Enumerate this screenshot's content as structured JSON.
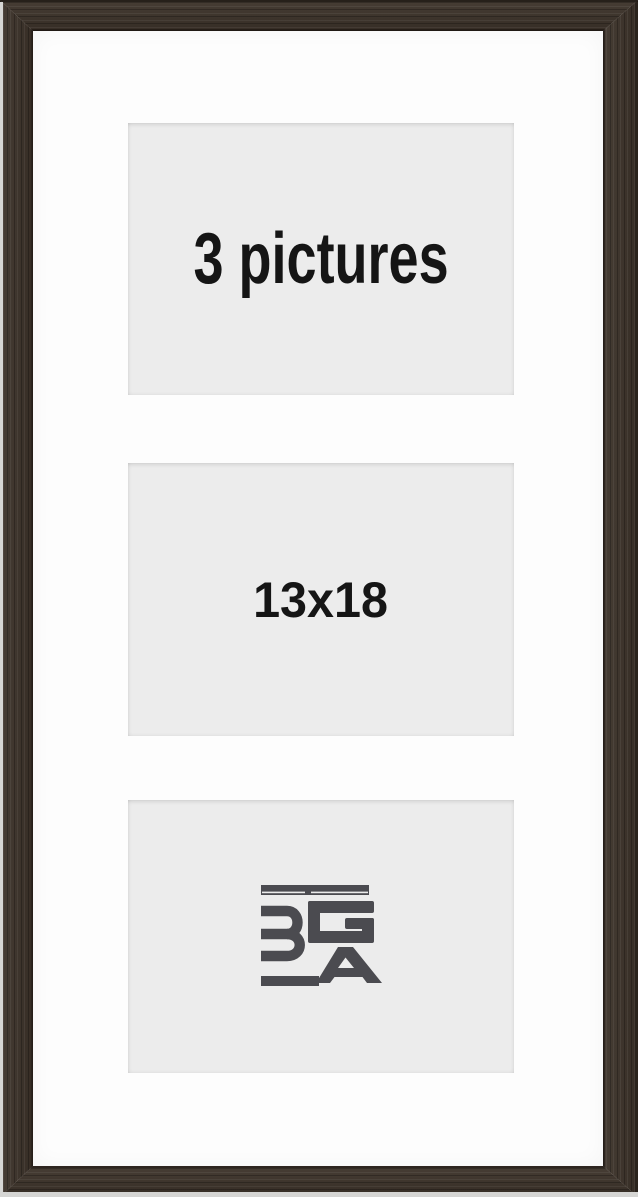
{
  "frame_photo": {
    "description": "triple-opening picture frame product photo",
    "openings": [
      {
        "type": "text",
        "label": "3 pictures"
      },
      {
        "type": "text",
        "label": "13x18"
      },
      {
        "type": "logo",
        "label": "BGA"
      }
    ],
    "colors": {
      "frame_wood": "#3d332a",
      "frame_edge_light": "#d6d6d4",
      "mat": "#fdfdfd",
      "opening_background": "#ececec",
      "label_text": "#151515",
      "logo_gray": "#4b4b50"
    }
  }
}
